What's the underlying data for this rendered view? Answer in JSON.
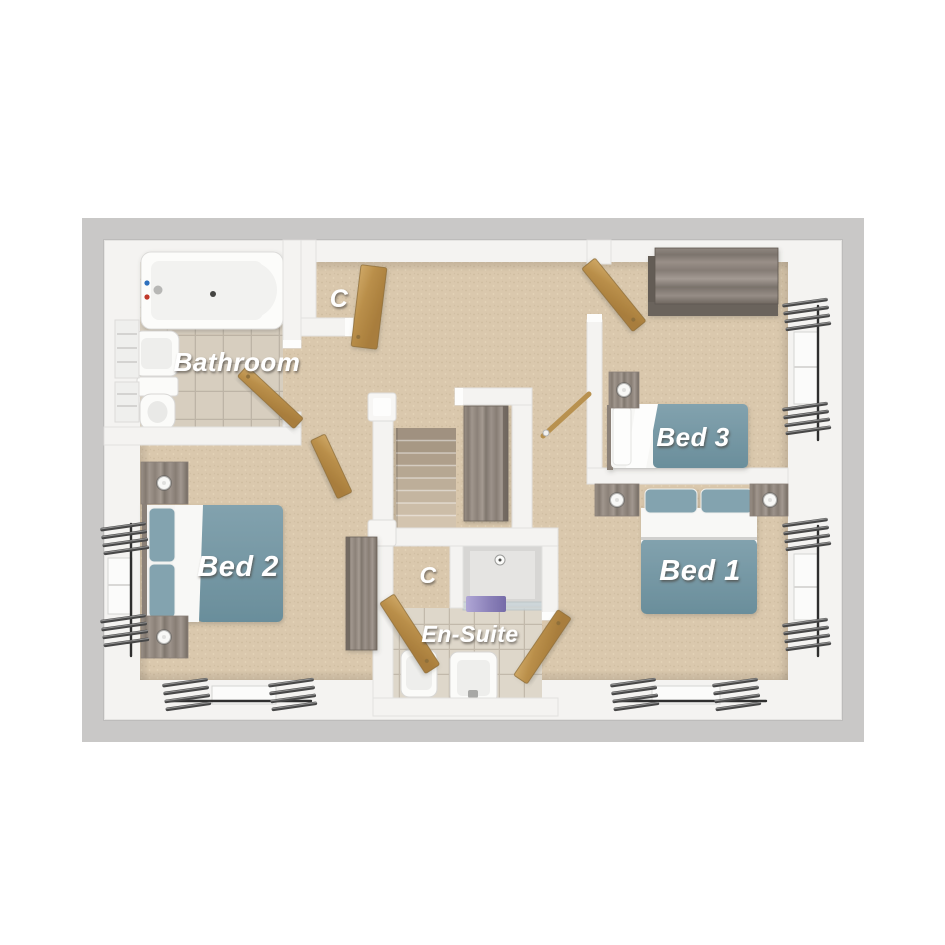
{
  "plan": {
    "type": "floor-plan-3d-render",
    "labels": {
      "bathroom": "Bathroom",
      "closet_top": "C",
      "closet_middle": "C",
      "en_suite": "En-Suite",
      "bed_1": "Bed 1",
      "bed_2": "Bed 2",
      "bed_3": "Bed 3"
    },
    "rooms": [
      {
        "name": "Bathroom",
        "label": "Bathroom",
        "fixtures": [
          "bathtub",
          "pedestal-basin",
          "toilet",
          "radiator"
        ]
      },
      {
        "name": "Closet",
        "label": "C",
        "location": "top-landing",
        "fixtures": [
          "door"
        ]
      },
      {
        "name": "Bed 3",
        "label": "Bed 3",
        "fixtures": [
          "single-bed",
          "bedside-table",
          "lamp",
          "wardrobe",
          "window"
        ]
      },
      {
        "name": "Bed 2",
        "label": "Bed 2",
        "fixtures": [
          "double-bed",
          "bedside-table",
          "bedside-table",
          "tall-cabinet",
          "window",
          "window"
        ]
      },
      {
        "name": "Bed 1",
        "label": "Bed 1",
        "fixtures": [
          "double-bed",
          "bedside-table",
          "bedside-table",
          "window",
          "window"
        ]
      },
      {
        "name": "En-Suite",
        "label": "En-Suite",
        "fixtures": [
          "shower",
          "pedestal-basin",
          "toilet",
          "shower-mat"
        ]
      },
      {
        "name": "Closet",
        "label": "C",
        "location": "en-suite",
        "fixtures": [
          "door"
        ]
      },
      {
        "name": "Landing",
        "fixtures": [
          "staircase",
          "storage-cabinet"
        ]
      }
    ],
    "palette": {
      "canvas": "#ffffff",
      "base_plate": "#c9c8c7",
      "walls": "#f4f3f1",
      "carpet": "#dac8ad",
      "bathroom_tile": "#d7cebf",
      "ensuite_tile": "#ded7ca",
      "bed_linen": "#7396a2",
      "pillow": "#83a3af",
      "duvet": "#f8f8f6",
      "door_wood": "#b98e49",
      "cabinet_wood": "#8b8178",
      "curtain": "#474747",
      "shower_mat": "#8a80b8",
      "label_text": "#ffffff"
    }
  }
}
